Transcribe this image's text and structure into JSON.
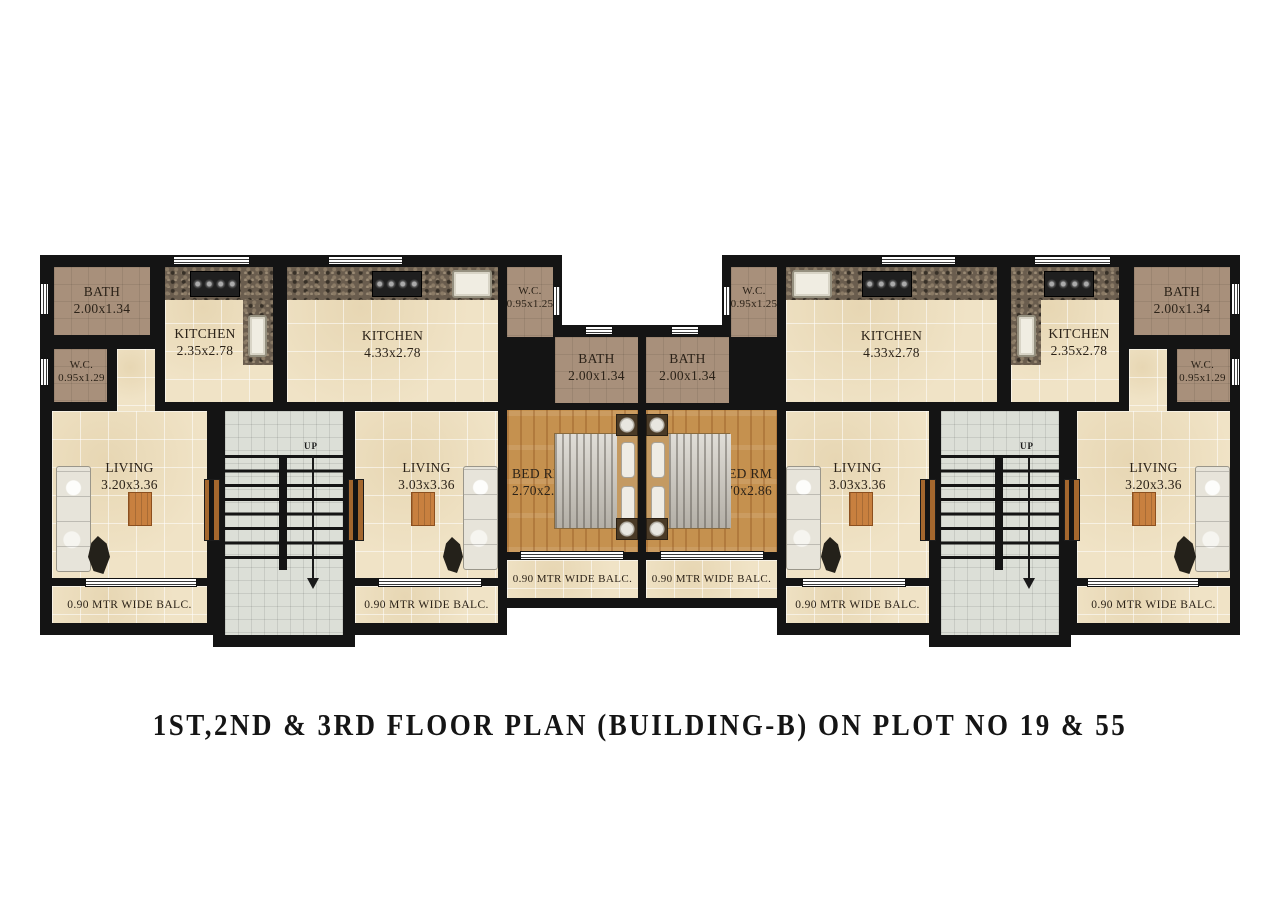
{
  "title": "1ST,2ND & 3RD FLOOR PLAN (BUILDING-B) ON PLOT NO 19 & 55",
  "up_label": "UP",
  "balcony_label": "0.90 MTR WIDE BALC.",
  "rooms": {
    "bath_far_left": {
      "name": "BATH",
      "dims": "2.00x1.34"
    },
    "wc_far_left": {
      "name": "W.C.",
      "dims": "0.95x1.29"
    },
    "kitchen_small_left": {
      "name": "KITCHEN",
      "dims": "2.35x2.78"
    },
    "kitchen_large_left": {
      "name": "KITCHEN",
      "dims": "4.33x2.78"
    },
    "wc_center_left": {
      "name": "W.C.",
      "dims": "0.95x1.25"
    },
    "bath_center_left": {
      "name": "BATH",
      "dims": "2.00x1.34"
    },
    "bath_center_right": {
      "name": "BATH",
      "dims": "2.00x1.34"
    },
    "wc_center_right": {
      "name": "W.C.",
      "dims": "0.95x1.25"
    },
    "kitchen_large_right": {
      "name": "KITCHEN",
      "dims": "4.33x2.78"
    },
    "kitchen_small_right": {
      "name": "KITCHEN",
      "dims": "2.35x2.78"
    },
    "bath_far_right": {
      "name": "BATH",
      "dims": "2.00x1.34"
    },
    "wc_far_right": {
      "name": "W.C.",
      "dims": "0.95x1.29"
    },
    "living_far_left": {
      "name": "LIVING",
      "dims": "3.20x3.36"
    },
    "living_center_left": {
      "name": "LIVING",
      "dims": "3.03x3.36"
    },
    "bed_left": {
      "name": "BED RM",
      "dims": "2.70x2.86"
    },
    "bed_right": {
      "name": "BED RM",
      "dims": "2.70x2.86"
    },
    "living_center_right": {
      "name": "LIVING",
      "dims": "3.03x3.36"
    },
    "living_far_right": {
      "name": "LIVING",
      "dims": "3.20x3.36"
    }
  },
  "colors": {
    "wall": "#141414",
    "floor_tile": "#f0e3c6",
    "wet_area_tile": "#a8907b",
    "wood_floor": "#c5914f",
    "granite_counter": "#6a5d4e",
    "stairs": "#dcdfd7",
    "background": "#ffffff"
  }
}
